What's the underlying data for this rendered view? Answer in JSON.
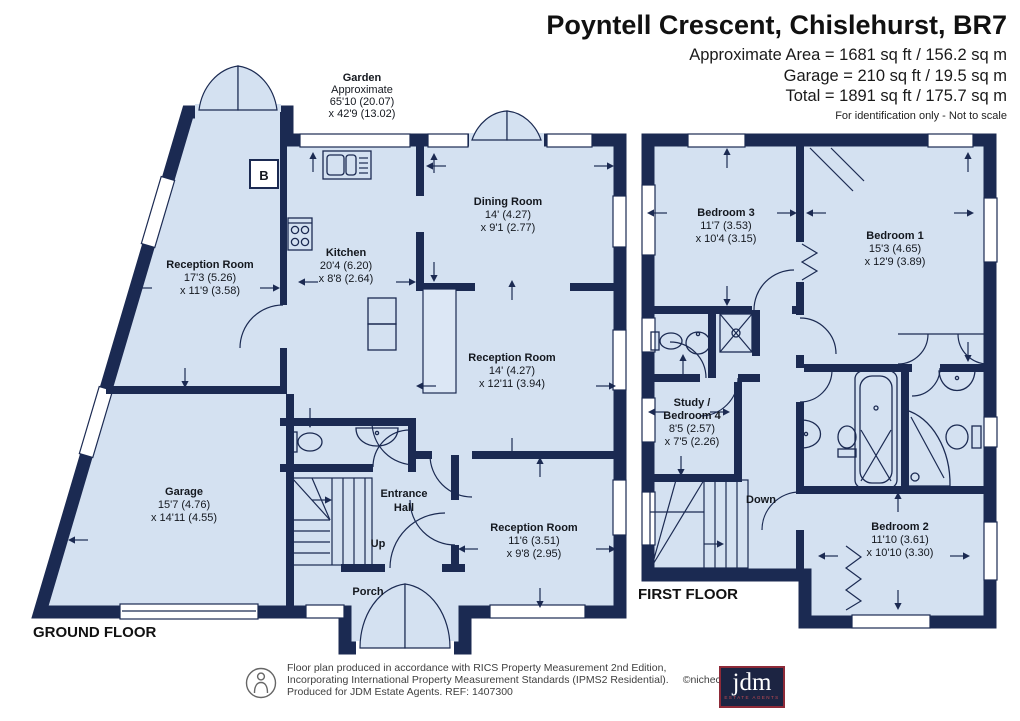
{
  "header": {
    "title": "Poyntell Crescent, Chislehurst, BR7",
    "area_line1": "Approximate Area = 1681 sq ft / 156.2 sq m",
    "area_line2": "Garage = 210 sq ft / 19.5 sq m",
    "area_line3": "Total = 1891 sq ft / 175.7 sq m",
    "disclaimer": "For identification only - Not to scale"
  },
  "garden": {
    "name": "Garden",
    "l1": "Approximate",
    "l2": "65'10 (20.07)",
    "l3": "x 42'9 (13.02)"
  },
  "ground": {
    "label": "GROUND FLOOR",
    "up": "Up",
    "boiler": "B",
    "rooms": {
      "reception1": {
        "name": "Reception Room",
        "d1": "17'3 (5.26)",
        "d2": "x 11'9 (3.58)"
      },
      "kitchen": {
        "name": "Kitchen",
        "d1": "20'4 (6.20)",
        "d2": "x 8'8 (2.64)"
      },
      "dining": {
        "name": "Dining Room",
        "d1": "14' (4.27)",
        "d2": "x 9'1 (2.77)"
      },
      "reception2": {
        "name": "Reception Room",
        "d1": "14' (4.27)",
        "d2": "x 12'11 (3.94)"
      },
      "reception3": {
        "name": "Reception Room",
        "d1": "11'6 (3.51)",
        "d2": "x 9'8 (2.95)"
      },
      "garage": {
        "name": "Garage",
        "d1": "15'7 (4.76)",
        "d2": "x 14'11 (4.55)"
      },
      "entrance_hall": {
        "name": "Entrance",
        "name2": "Hall"
      },
      "porch": {
        "name": "Porch"
      }
    }
  },
  "first": {
    "label": "FIRST FLOOR",
    "down": "Down",
    "rooms": {
      "bedroom3": {
        "name": "Bedroom 3",
        "d1": "11'7 (3.53)",
        "d2": "x 10'4 (3.15)"
      },
      "bedroom1": {
        "name": "Bedroom 1",
        "d1": "15'3 (4.65)",
        "d2": "x 12'9 (3.89)"
      },
      "study": {
        "name": "Study /",
        "name2": "Bedroom 4",
        "d1": "8'5 (2.57)",
        "d2": "x 7'5 (2.26)"
      },
      "bedroom2": {
        "name": "Bedroom 2",
        "d1": "11'10 (3.61)",
        "d2": "x 10'10 (3.30)"
      }
    }
  },
  "footer": {
    "line1": "Floor plan produced in accordance with RICS Property Measurement 2nd Edition,",
    "line2": "Incorporating International Property Measurement Standards (IPMS2 Residential).",
    "copyright": "©nichecom 2026.",
    "line3": "Produced for JDM Estate Agents.   REF: 1407300",
    "logo_text": "jdm",
    "logo_sub": "ESTATE AGENTS"
  },
  "colors": {
    "wall_navy": "#1b2a52",
    "room_fill": "#d4e1f1",
    "logo_red": "#8e2a38"
  }
}
